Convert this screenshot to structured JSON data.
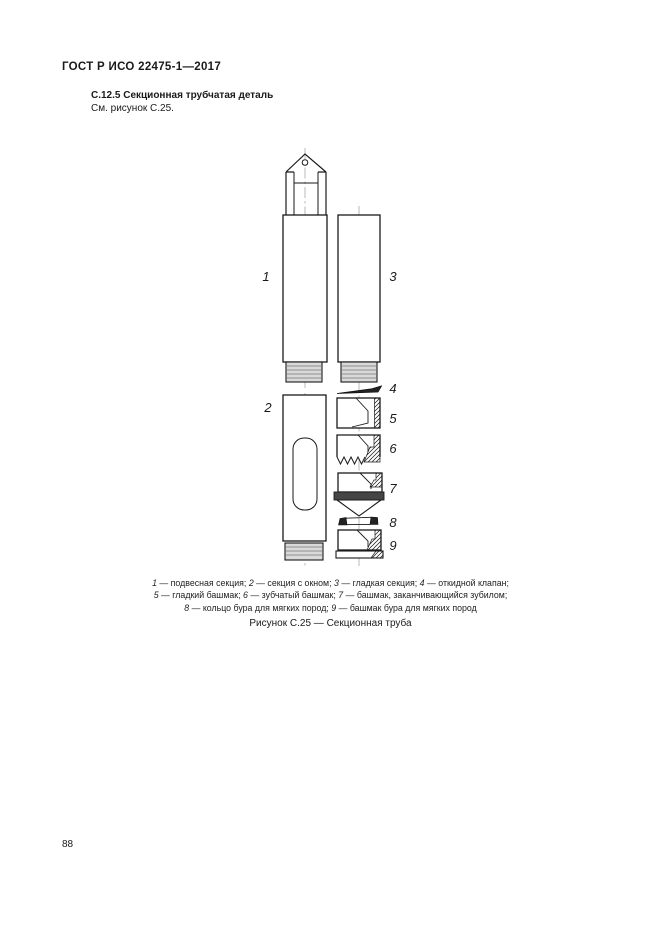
{
  "page": {
    "header": "ГОСТ Р ИСО 22475-1—2017",
    "page_number": "88"
  },
  "section": {
    "heading": "С.12.5 Секционная трубчатая деталь",
    "reference": "См. рисунок С.25."
  },
  "figure": {
    "caption": "Рисунок С.25 — Секционная труба",
    "labels": [
      "1",
      "2",
      "3",
      "4",
      "5",
      "6",
      "7",
      "8",
      "9"
    ],
    "legend": {
      "lines": [
        {
          "parts": [
            {
              "num": "1",
              "text": " — подвесная секция; "
            },
            {
              "num": "2",
              "text": " — секция с окном; "
            },
            {
              "num": "3",
              "text": " — гладкая секция; "
            },
            {
              "num": "4",
              "text": " — откидной клапан;"
            }
          ]
        },
        {
          "parts": [
            {
              "num": "5",
              "text": " — гладкий башмак; "
            },
            {
              "num": "6",
              "text": " — зубчатый башмак; "
            },
            {
              "num": "7",
              "text": " — башмак, заканчивающийся зубилом;"
            }
          ]
        },
        {
          "parts": [
            {
              "num": "8",
              "text": " — кольцо бура для мягких пород; "
            },
            {
              "num": "9",
              "text": " — башмак бура для мягких пород"
            }
          ]
        }
      ]
    }
  }
}
